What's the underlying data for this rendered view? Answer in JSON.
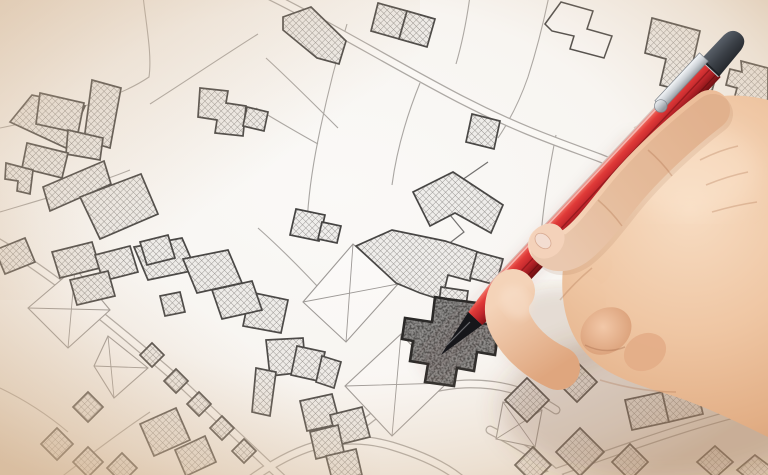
{
  "scene": {
    "type": "photo-style illustration",
    "subject": "Hand holding a red mechanical pencil pointing at a highlighted parcel of an imaginary cadastral map",
    "text_content": "none",
    "map_kind": "cadastral parcel map with cross-hatched buildings, roads and courtyard lots",
    "highlight": "dark grey speckled parcel under the pencil tip"
  },
  "palette": {
    "paper_center": "#faf9f7",
    "paper_corner_tint": "#d8bda4",
    "parcel_line": "#a8a5a2",
    "building_outline": "#434241",
    "building_hatch": "#908e8c",
    "building_fill": "#efeeec",
    "road_fill": "#fcfbf9",
    "road_edge": "#aaa7a4",
    "selected_parcel_fill": "#8a8a8a",
    "selected_parcel_outline": "#1f1f1f",
    "pencil_red": "#c2272c",
    "pencil_red_dark": "#6e1013",
    "pencil_tip": "#16161a",
    "pencil_cap": "#3a3f46",
    "pencil_clip": "#cdd2d7",
    "skin_light": "#f7dcc2",
    "skin_mid": "#efc6a3",
    "skin_shadow": "#cb916a"
  }
}
